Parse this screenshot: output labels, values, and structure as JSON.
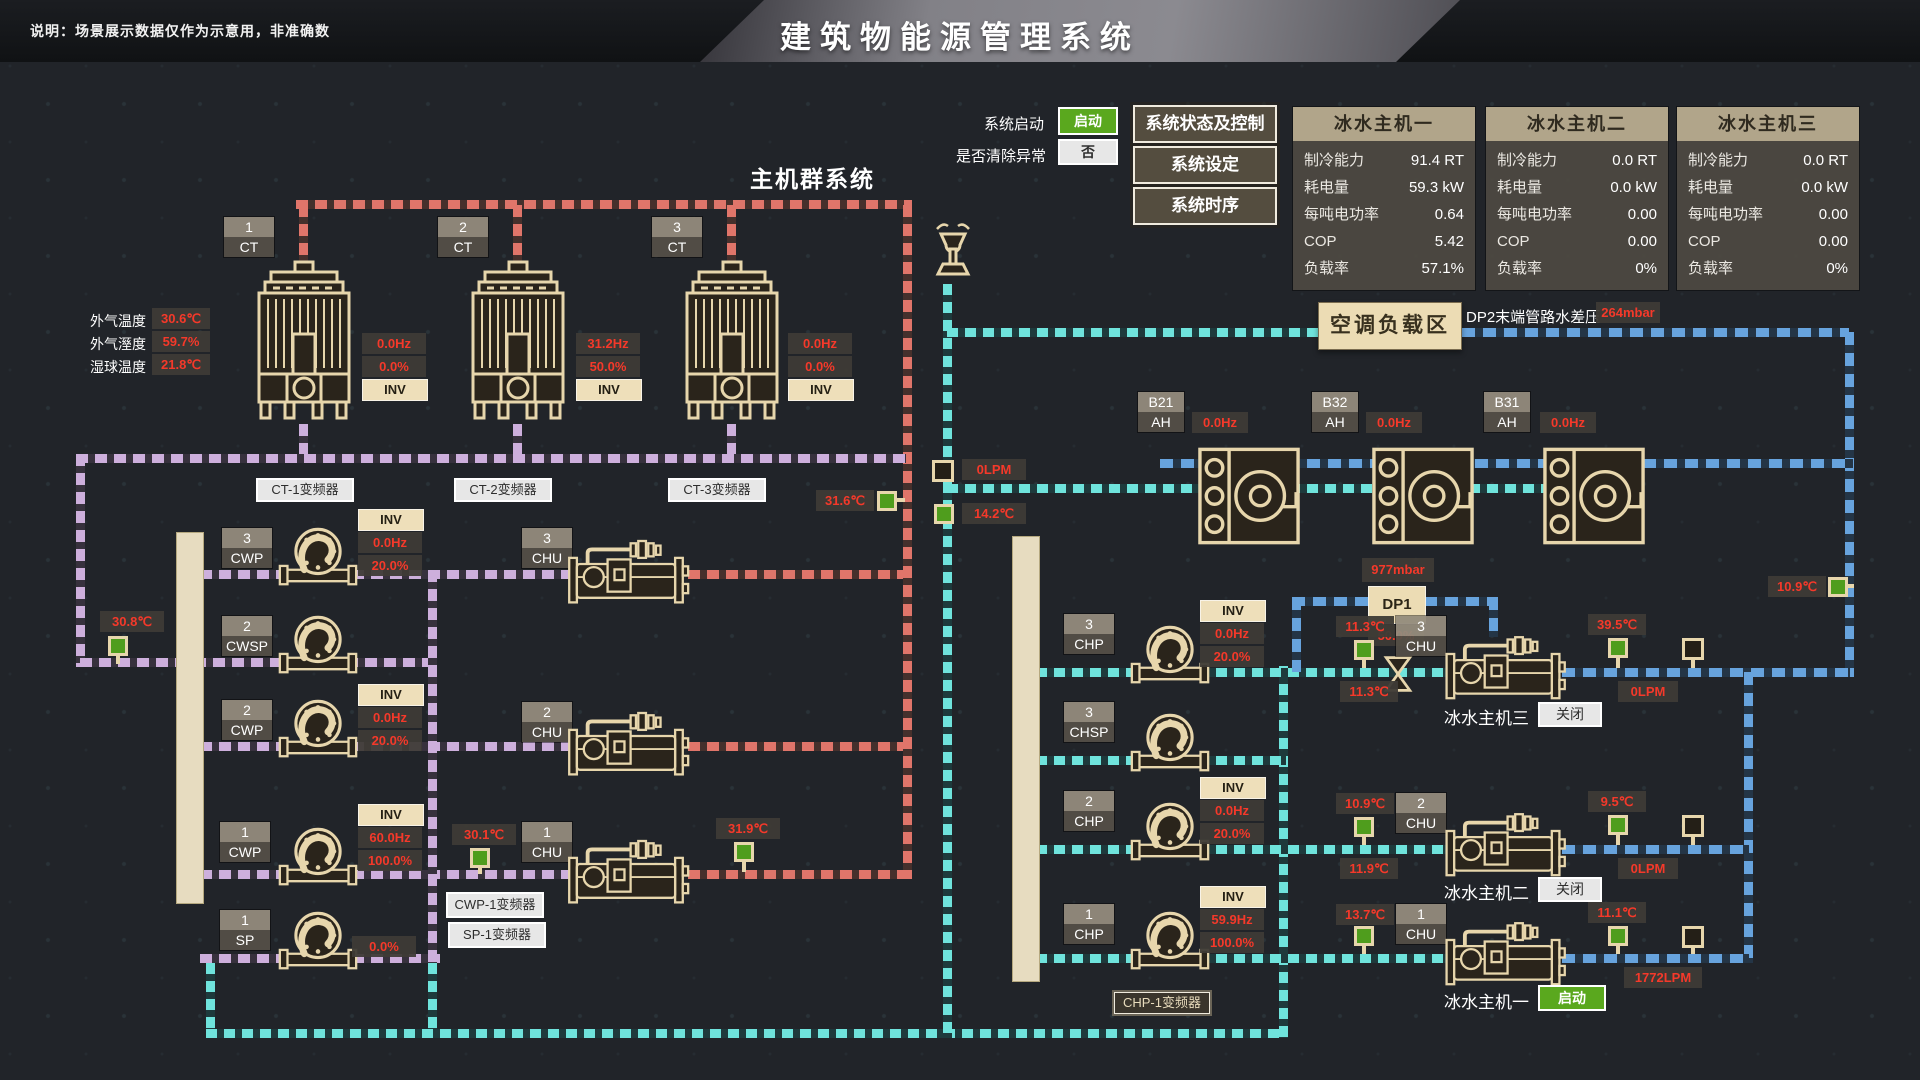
{
  "header": {
    "note": "说明：场景展示数据仅作为示意用，非准确数",
    "title": "建筑物能源管理系统"
  },
  "controls": {
    "start_label": "系统启动",
    "start_value": "启动",
    "clear_label": "是否清除异常",
    "clear_value": "否",
    "buttons": [
      "系统状态及控制",
      "系统设定",
      "系统时序"
    ]
  },
  "panels": [
    {
      "title": "冰水主机一",
      "rows": [
        [
          "制冷能力",
          "91.4 RT"
        ],
        [
          "耗电量",
          "59.3 kW"
        ],
        [
          "每吨电功率",
          "0.64"
        ],
        [
          "COP",
          "5.42"
        ],
        [
          "负载率",
          "57.1%"
        ]
      ]
    },
    {
      "title": "冰水主机二",
      "rows": [
        [
          "制冷能力",
          "0.0 RT"
        ],
        [
          "耗电量",
          "0.0 kW"
        ],
        [
          "每吨电功率",
          "0.00"
        ],
        [
          "COP",
          "0.00"
        ],
        [
          "负载率",
          "0%"
        ]
      ]
    },
    {
      "title": "冰水主机三",
      "rows": [
        [
          "制冷能力",
          "0.0 RT"
        ],
        [
          "耗电量",
          "0.0 kW"
        ],
        [
          "每吨电功率",
          "0.00"
        ],
        [
          "COP",
          "0.00"
        ],
        [
          "负载率",
          "0%"
        ]
      ]
    }
  ],
  "plant_title": "主机群系统",
  "weather": [
    [
      "外气温度",
      "30.6℃"
    ],
    [
      "外气溼度",
      "59.7%"
    ],
    [
      "湿球温度",
      "21.8℃"
    ]
  ],
  "towers": [
    {
      "num": "1",
      "type": "CT",
      "hz": "0.0Hz",
      "pct": "0.0%",
      "inv": "INV",
      "vfd": "CT-1变频器"
    },
    {
      "num": "2",
      "type": "CT",
      "hz": "31.2Hz",
      "pct": "50.0%",
      "inv": "INV",
      "vfd": "CT-2变频器"
    },
    {
      "num": "3",
      "type": "CT",
      "hz": "0.0Hz",
      "pct": "0.0%",
      "inv": "INV",
      "vfd": "CT-3变频器"
    }
  ],
  "pumps_left": [
    {
      "num": "3",
      "type": "CWP",
      "inv": "INV",
      "hz": "0.0Hz",
      "pct": "20.0%"
    },
    {
      "num": "2",
      "type": "CWSP"
    },
    {
      "num": "2",
      "type": "CWP",
      "inv": "INV",
      "hz": "0.0Hz",
      "pct": "20.0%"
    },
    {
      "num": "1",
      "type": "CWP",
      "inv": "INV",
      "hz": "60.0Hz",
      "pct": "100.0%"
    },
    {
      "num": "1",
      "type": "SP",
      "pct": "0.0%"
    }
  ],
  "chu_left": [
    {
      "num": "3",
      "type": "CHU"
    },
    {
      "num": "2",
      "type": "CHU"
    },
    {
      "num": "1",
      "type": "CHU"
    }
  ],
  "sensors": {
    "cw_return": "30.8℃",
    "cw_supply": "30.1℃",
    "chu1_out": "31.9℃",
    "cond_riser": "31.6℃",
    "flow_bypass": "0LPM",
    "chw_bypass": "14.2℃",
    "chw_right": "10.9℃"
  },
  "vfd_buttons": {
    "cwp1": "CWP-1变频器",
    "sp1": "SP-1变频器",
    "chp1": "CHP-1变频器"
  },
  "load_zone": {
    "label": "空调负载区",
    "dp2_label": "DP2末端管路水差压",
    "dp2_value": "264mbar",
    "dp1_top": "977mbar",
    "dp1_label": "DP1",
    "dp1_value": "50.0%"
  },
  "ahus": [
    {
      "num": "B21",
      "type": "AH",
      "hz": "0.0Hz"
    },
    {
      "num": "B32",
      "type": "AH",
      "hz": "0.0Hz"
    },
    {
      "num": "B31",
      "type": "AH",
      "hz": "0.0Hz"
    }
  ],
  "pumps_right": [
    {
      "num": "3",
      "type": "CHP",
      "inv": "INV",
      "hz": "0.0Hz",
      "pct": "20.0%"
    },
    {
      "num": "3",
      "type": "CHSP"
    },
    {
      "num": "2",
      "type": "CHP",
      "inv": "INV",
      "hz": "0.0Hz",
      "pct": "20.0%"
    },
    {
      "num": "1",
      "type": "CHP",
      "inv": "INV",
      "hz": "59.9Hz",
      "pct": "100.0%"
    }
  ],
  "chillers_right": [
    {
      "num": "3",
      "type": "CHU",
      "name": "冰水主机三",
      "btn": "关闭",
      "t_in": "11.3℃",
      "t_ret": "11.3℃",
      "t_out": "39.5℃",
      "flow": "0LPM"
    },
    {
      "num": "2",
      "type": "CHU",
      "name": "冰水主机二",
      "btn": "关闭",
      "t_in": "10.9℃",
      "t_ret": "11.9℃",
      "t_out": "9.5℃",
      "flow": "0LPM"
    },
    {
      "num": "1",
      "type": "CHU",
      "name": "冰水主机一",
      "btn": "启动",
      "t_in": "13.7℃",
      "t_out": "11.1℃",
      "flow": "1772LPM"
    }
  ],
  "colors": {
    "green": "#5aa81e",
    "red": "#f5392a",
    "tan": "#e7d6ac",
    "pipe_red": "#e0756a",
    "pipe_purple": "#cdafdc",
    "pipe_cyan": "#6fe3dc",
    "pipe_blue": "#67a3dd"
  }
}
